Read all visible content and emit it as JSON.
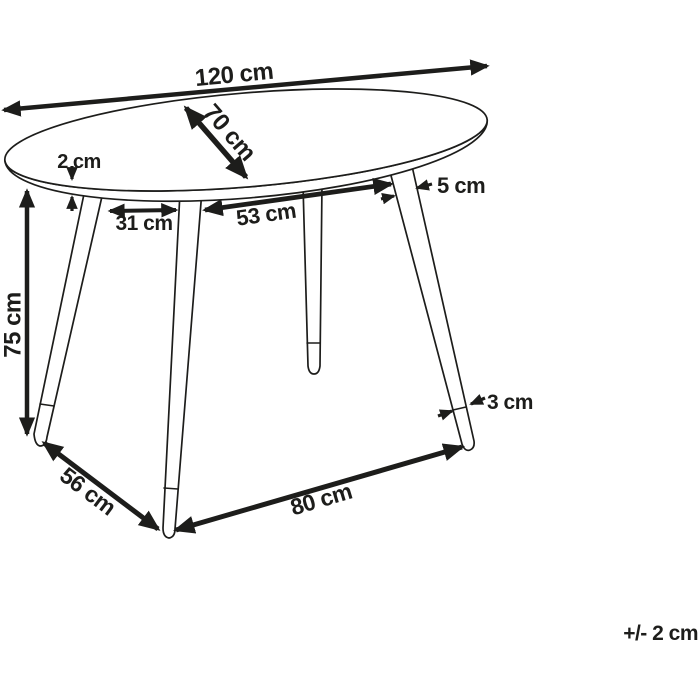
{
  "diagram": {
    "type": "furniture-dimension-drawing",
    "subject": "oval table with four splayed legs",
    "unit": "cm",
    "background_color": "#ffffff",
    "line_color": "#1d1d1b",
    "labels": {
      "top_length": "120 cm",
      "top_width": "70 cm",
      "top_thickness": "2 cm",
      "leg_width_top": "5 cm",
      "leg_inset_left": "31 cm",
      "leg_gap_top_front": "53 cm",
      "height": "75 cm",
      "leg_width_bottom": "3 cm",
      "feet_gap_left": "56 cm",
      "feet_gap_front": "80 cm",
      "tolerance": "+/- 2 cm"
    }
  }
}
